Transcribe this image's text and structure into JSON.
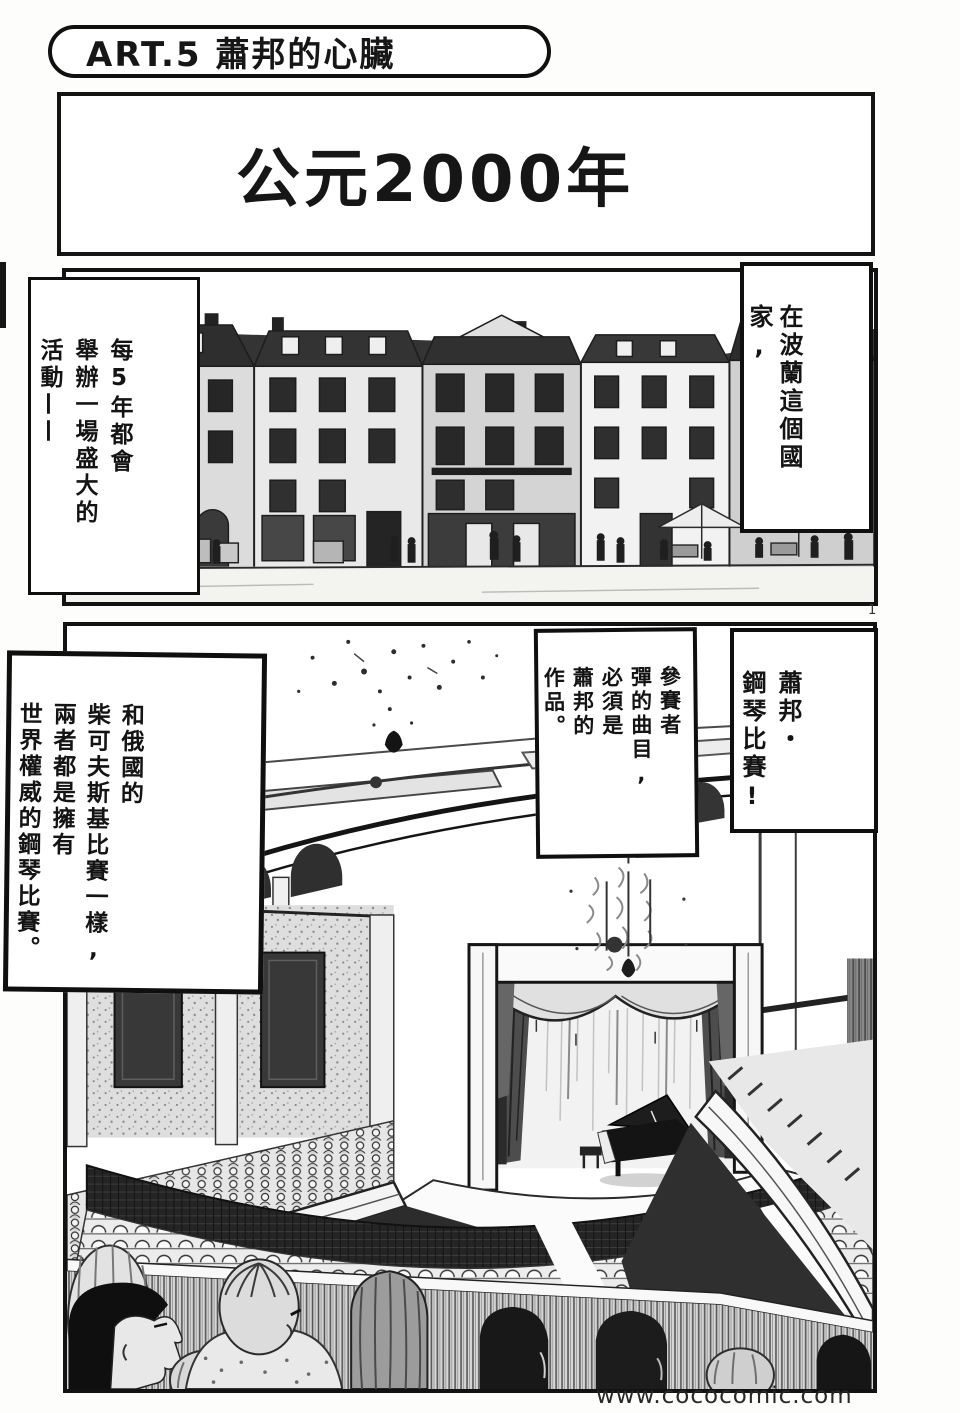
{
  "colors": {
    "ink": "#121212",
    "paper": "#fdfdfc",
    "watermark": "#282828",
    "roof_dark": "#2e2e2e",
    "curtain_gray": "#4d4d4d"
  },
  "header": {
    "title": "ART.5 蕭邦的心臟"
  },
  "caption": {
    "year": "公元2000年"
  },
  "balloons": {
    "every5": {
      "cols": [
        "每5年都會",
        "舉辦一場盛大的",
        "活動——"
      ]
    },
    "poland": {
      "cols": [
        "在波蘭這個國家,"
      ]
    },
    "contestant": {
      "cols": [
        "參賽者",
        "彈的曲目,",
        "必須是",
        "蕭邦的",
        "作品。"
      ]
    },
    "chopin": {
      "cols": [
        "蕭邦・",
        "鋼琴比賽!"
      ]
    },
    "tchaikovsky": {
      "cols": [
        "和俄國的",
        "柴可夫斯基比賽一樣,",
        "兩者都是擁有",
        "世界權威的鋼琴比賽。"
      ]
    }
  },
  "page_number": "1",
  "watermark": "www.cococomic.com"
}
